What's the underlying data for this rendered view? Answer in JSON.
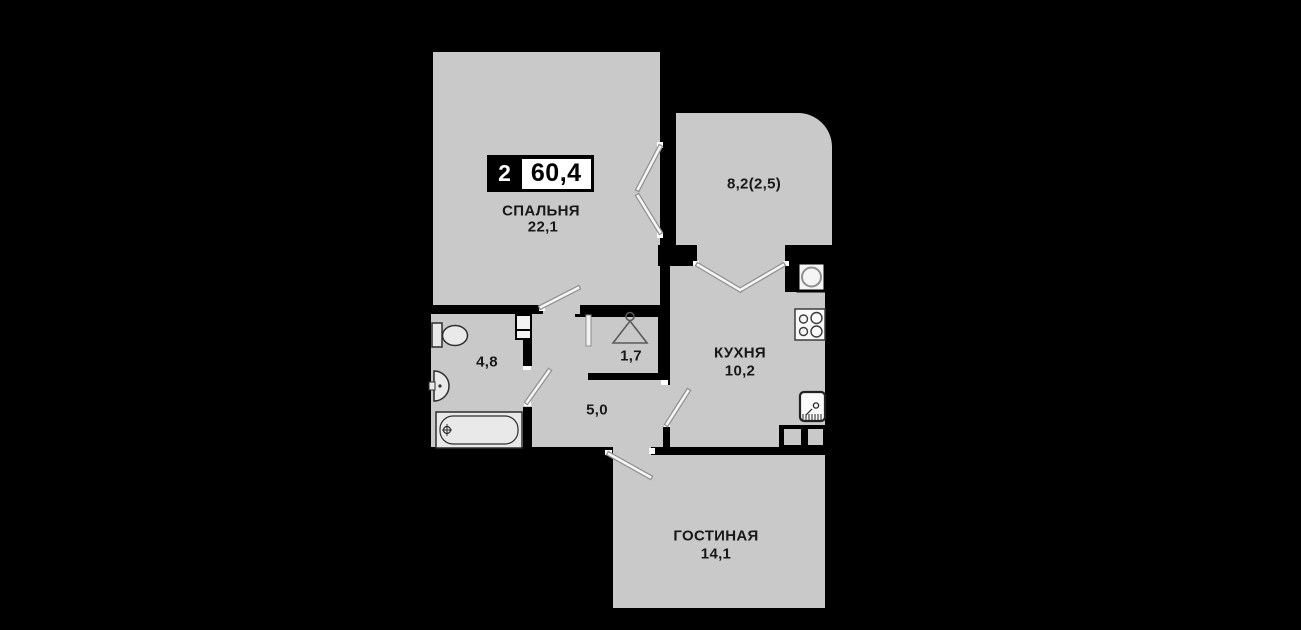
{
  "plan": {
    "badge": {
      "rooms_count": "2",
      "total_area": "60,4"
    }
  },
  "rooms": {
    "bedroom": {
      "name": "СПАЛЬНЯ",
      "area": "22,1"
    },
    "loggia": {
      "area": "8,2(2,5)"
    },
    "kitchen": {
      "name": "КУХНЯ",
      "area": "10,2"
    },
    "bathroom": {
      "area": "4,8"
    },
    "wardrobe": {
      "area": "1,7"
    },
    "hallway": {
      "area": "5,0"
    },
    "living_room": {
      "name": "ГОСТИНАЯ",
      "area": "14,1"
    }
  },
  "icons": {
    "toilet": "toilet-icon",
    "bath_sink": "sink-icon",
    "bathtub": "bathtub-icon",
    "hanger": "hanger-icon",
    "washing_machine": "washing-machine-icon",
    "stove": "stove-icon",
    "kitchen_sink": "kitchen-sink-icon",
    "cabinets": "kitchen-cabinets-icon"
  },
  "colors": {
    "background": "#000000",
    "room_fill": "#c9c9c9",
    "wall": "#000000",
    "badge_bg": "#000000",
    "badge_box": "#ffffff",
    "text": "#181818",
    "door_line": "#f5f5f5"
  }
}
